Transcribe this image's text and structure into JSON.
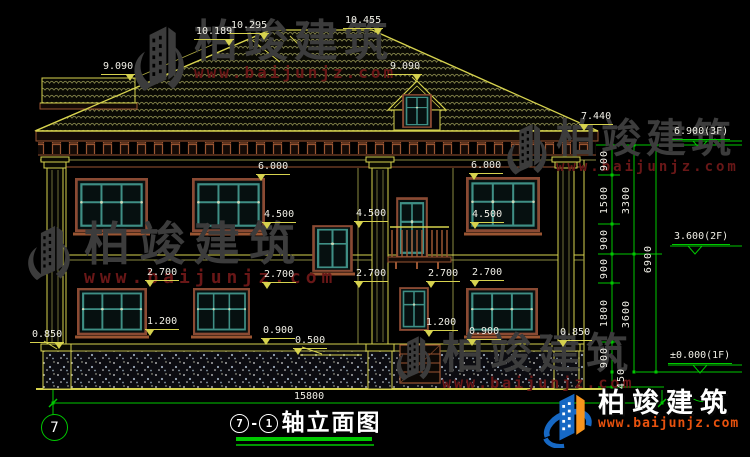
{
  "drawing": {
    "title": {
      "axis_from": "7",
      "separator": "-",
      "axis_to": "1",
      "name": "轴立面图"
    },
    "grid_bubble": "7",
    "levels": {
      "ridge_hip": "10.189",
      "ridge_mid": "10.295",
      "ridge_top": "10.455",
      "wing_roof": "9.090",
      "eave": "7.440",
      "floor3": "6.900(3F)",
      "floor2": "3.600(2F)",
      "floor1": "±0.000(1F)",
      "win2_head": "6.000",
      "win2_sill": "4.500",
      "win1_head": "2.700",
      "win1_sill": "1.200",
      "win1_sill_low": "0.900",
      "plinth": "0.850",
      "porch_slab": "0.500"
    },
    "vdims_inner": [
      "900",
      "1500",
      "900",
      "900",
      "1800",
      "900",
      "450"
    ],
    "vdims_mid": [
      "3300",
      "3600"
    ],
    "vdim_total": "6900",
    "hdim_total": "15800"
  },
  "watermark": {
    "brand": "柏竣建筑",
    "url": "www.baijunjz.com"
  },
  "colors": {
    "cad_yellow": "#d6d24e",
    "cad_green": "#00c800",
    "frame_brown": "#9a5532",
    "window_teal": "#3f8f85",
    "dim_text": "#f0efe6",
    "logo_blue": "#1668c4",
    "logo_orange": "#f7941d",
    "logo_url_red": "#e8520e"
  }
}
